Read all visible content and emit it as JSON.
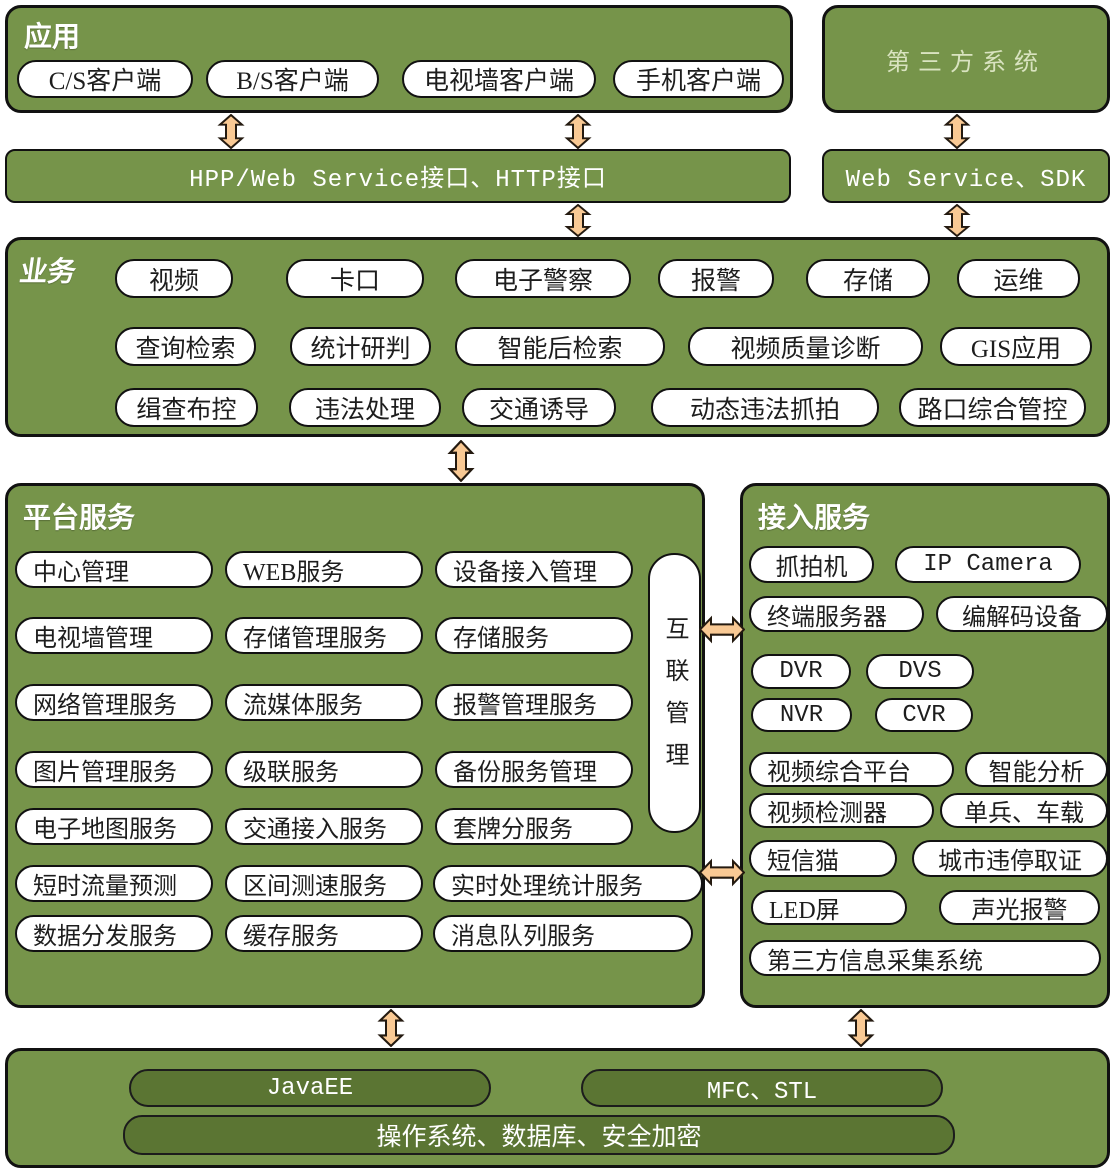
{
  "colors": {
    "panel_green": "#76944A",
    "dark_green": "#5B7533",
    "arrow_orange": "#F9C994",
    "pill_border": "#111111",
    "third_party_text": "#D9E3C0"
  },
  "app": {
    "title": "应用",
    "pills": [
      "C/S客户端",
      "B/S客户端",
      "电视墙客户端",
      "手机客户端"
    ]
  },
  "third_party": {
    "title": "第三方系统"
  },
  "interface_bars": {
    "hpp": "HPP/Web Service接口、HTTP接口",
    "sdk": "Web Service、SDK"
  },
  "business": {
    "title": "业务",
    "row1": [
      "视频",
      "卡口",
      "电子警察",
      "报警",
      "存储",
      "运维"
    ],
    "row2": [
      "查询检索",
      "统计研判",
      "智能后检索",
      "视频质量诊断",
      "GIS应用"
    ],
    "row3": [
      "缉查布控",
      "违法处理",
      "交通诱导",
      "动态违法抓拍",
      "路口综合管控"
    ]
  },
  "platform": {
    "title": "平台服务",
    "interconnect": "互联管理",
    "rows": [
      [
        "中心管理",
        "WEB服务",
        "设备接入管理"
      ],
      [
        "电视墙管理",
        "存储管理服务",
        "存储服务"
      ],
      [
        "网络管理服务",
        "流媒体服务",
        "报警管理服务"
      ],
      [
        "图片管理服务",
        "级联服务",
        "备份服务管理"
      ],
      [
        "电子地图服务",
        "交通接入服务",
        "套牌分服务"
      ],
      [
        "短时流量预测",
        "区间测速服务",
        "实时处理统计服务"
      ],
      [
        "数据分发服务",
        "缓存服务",
        "消息队列服务"
      ]
    ]
  },
  "access": {
    "title": "接入服务",
    "rows": [
      [
        "抓拍机",
        "IP Camera"
      ],
      [
        "终端服务器",
        "编解码设备"
      ],
      [
        "DVR",
        "DVS"
      ],
      [
        "NVR",
        "CVR"
      ],
      [
        "视频综合平台",
        "智能分析"
      ],
      [
        "视频检测器",
        "单兵、车载"
      ],
      [
        "短信猫",
        "城市违停取证"
      ],
      [
        "LED屏",
        "声光报警"
      ],
      [
        "第三方信息采集系统"
      ]
    ]
  },
  "foundation": {
    "frameworks": [
      "JavaEE",
      "MFC、STL"
    ],
    "base": "操作系统、数据库、安全加密"
  }
}
